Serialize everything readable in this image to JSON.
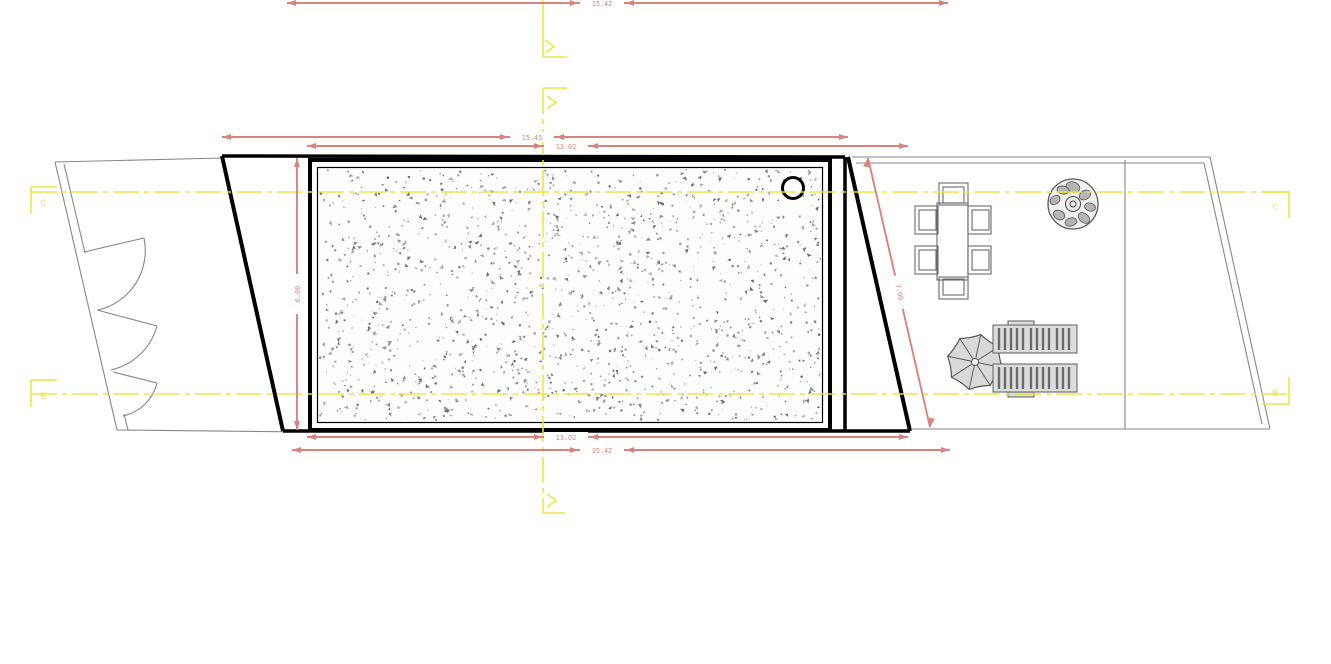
{
  "drawing": {
    "type": "site-plan",
    "dimensions": {
      "top_outer": "15.42",
      "top_row1": "15.45",
      "top_row2": "13.02",
      "bottom_row1": "13.02",
      "bottom_row2": "15.42",
      "left_vertical": "6.00",
      "right_diagonal": "7.00"
    },
    "grid_labels": {
      "left_top": "C",
      "left_bottom": "B",
      "right_top": "C",
      "right_bottom": "B"
    },
    "colors": {
      "dim": "#db827c",
      "cl": "#ece53a",
      "outline": "#878787",
      "black": "#000000",
      "furniture": "#6a6a6a",
      "furniture_fill": "#dcdcdc",
      "hatch_dark": "#6e6e6e",
      "hatch_mid": "#8a8a8a",
      "hatch_light": "#aaaaaa"
    },
    "symbols": {
      "tree": "tree-plan-icon",
      "umbrella": "parasol-icon",
      "table": "dining-table-icon",
      "chair": "chair-icon",
      "lounger": "sun-lounger-icon",
      "skimmer": "circle-fixture-icon",
      "section_marker": "match-line-arrow-icon"
    }
  }
}
